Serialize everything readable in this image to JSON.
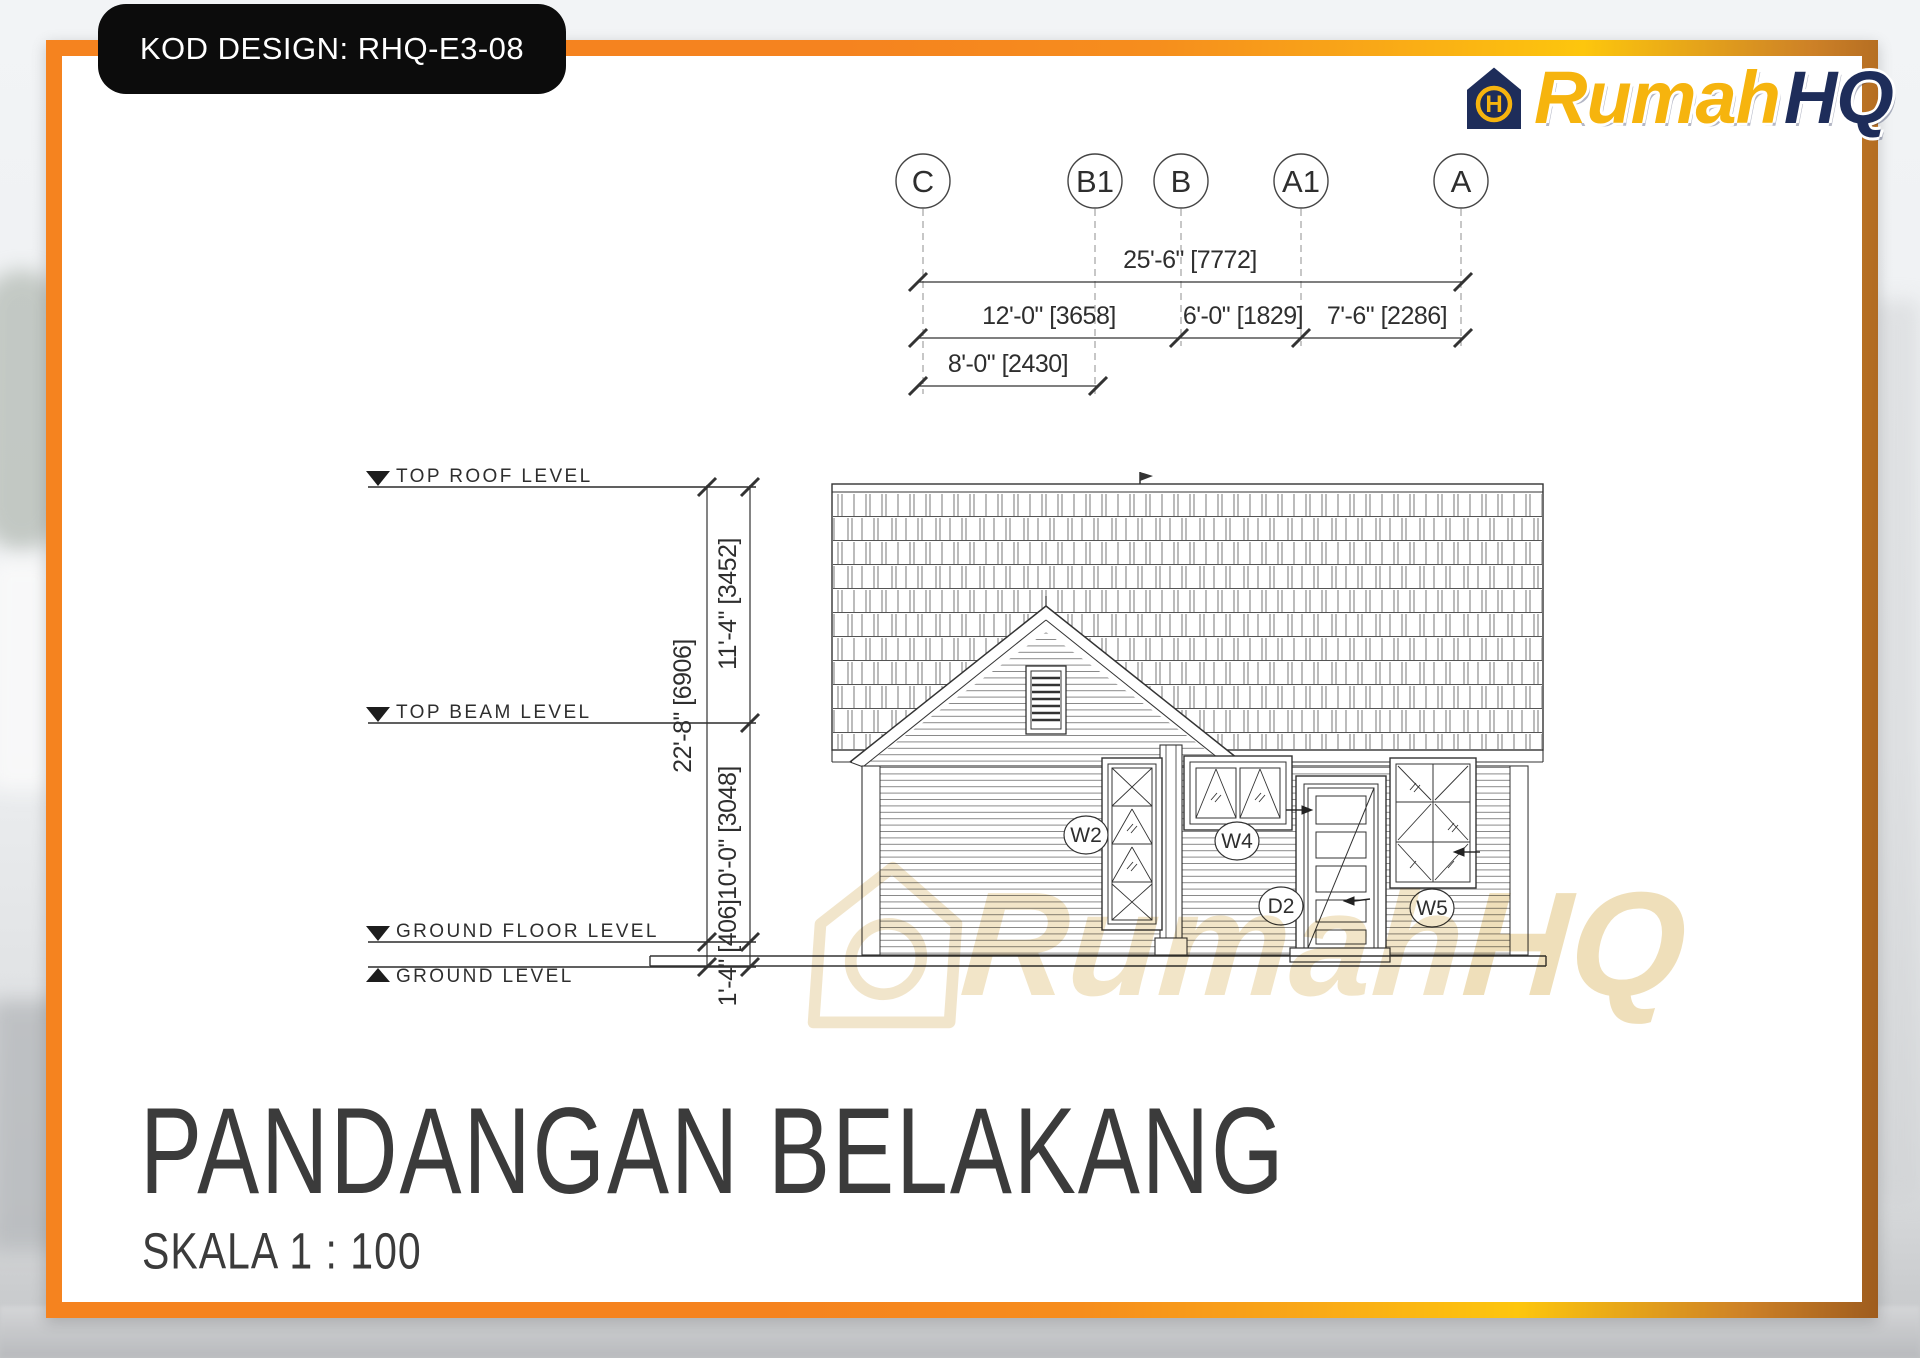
{
  "design_code_badge": "KOD DESIGN: RHQ-E3-08",
  "brand": {
    "name_primary": "Rumah",
    "name_secondary": "HQ",
    "monogram_letter": "H"
  },
  "grid": {
    "c": "C",
    "b1": "B1",
    "b": "B",
    "a1": "A1",
    "a": "A"
  },
  "dimensions_horizontal": {
    "overall": "25'-6\" [7772]",
    "bay_c_b": "12'-0\" [3658]",
    "bay_b_a1": "6'-0\" [1829]",
    "bay_a1_a": "7'-6\" [2286]",
    "bay_c_b1": "8'-0\" [2430]"
  },
  "dimensions_vertical": {
    "roof_to_beam": "11'-4\" [3452]",
    "overall_height": "22'-8\" [6906]",
    "beam_to_floor": "10'-0\" [3048]",
    "floor_to_ground": "1'-4\" [406]"
  },
  "levels": {
    "top_roof": "TOP ROOF LEVEL",
    "top_beam": "TOP BEAM LEVEL",
    "ground_floor": "GROUND FLOOR LEVEL",
    "ground": "GROUND LEVEL"
  },
  "openings": {
    "w2": "W2",
    "w4": "W4",
    "d2": "D2",
    "w5": "W5"
  },
  "title": {
    "heading": "PANDANGAN BELAKANG",
    "scale": "SKALA 1 : 100"
  },
  "watermark": {
    "text_primary": "Rumah",
    "text_secondary": "HQ"
  },
  "colors": {
    "frame_orange": "#F5831F",
    "frame_gold": "#FDC60D",
    "frame_brown": "#9E5C1E",
    "brand_gold": "#F6B40E",
    "brand_navy": "#1E2D5A",
    "line": "#2E2E2E"
  }
}
